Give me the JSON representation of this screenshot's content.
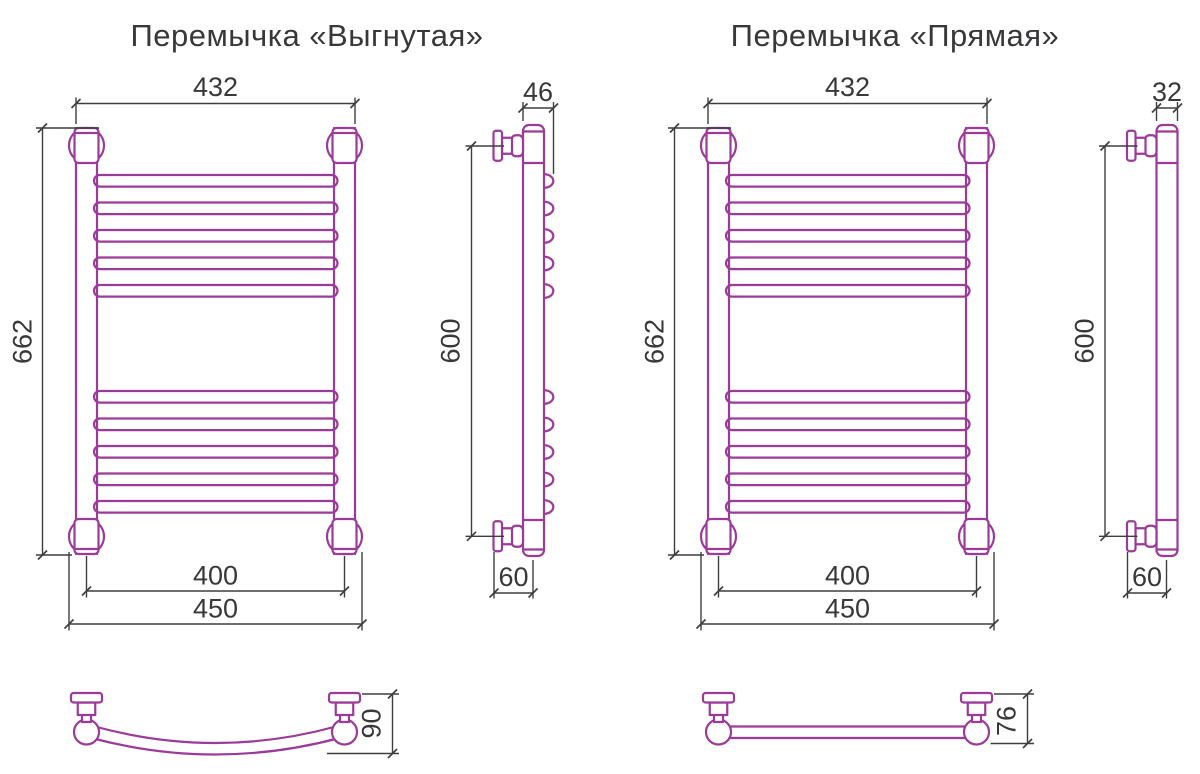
{
  "page": {
    "background": "#ffffff",
    "drawing_color": "#9C3A99",
    "dimension_color": "#3E3E40",
    "text_color": "#38383A"
  },
  "views": {
    "curved": {
      "title": "Перемычка «Выгнутая»",
      "front": {
        "top_width": "432",
        "height": "662",
        "axis_width": "400",
        "overall_width": "450"
      },
      "side": {
        "top_depth": "46",
        "height": "600",
        "bottom_depth": "60"
      },
      "plan": {
        "depth": "90"
      }
    },
    "straight": {
      "title": "Перемычка «Прямая»",
      "front": {
        "top_width": "432",
        "height": "662",
        "axis_width": "400",
        "overall_width": "450"
      },
      "side": {
        "top_depth": "32",
        "height": "600",
        "bottom_depth": "60"
      },
      "plan": {
        "depth": "76"
      }
    }
  }
}
